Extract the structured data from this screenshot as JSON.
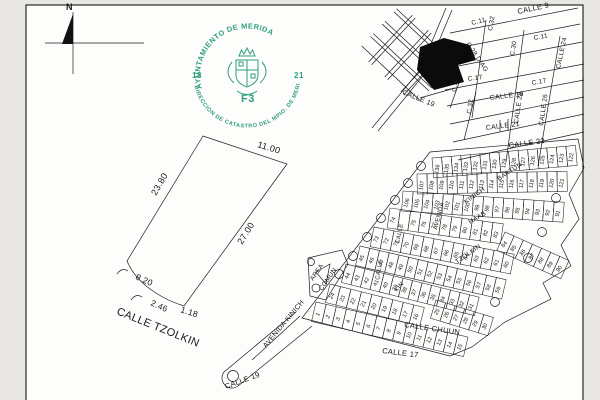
{
  "compass": {
    "label": "N"
  },
  "seal": {
    "top_text": "AYUNTAMIENTO DE MERIDA",
    "bottom_text": "DIRECCION DE CATASTRO DEL MPIO. DE MERIDA",
    "left_number": "18",
    "right_number": "21",
    "code": "F3",
    "color": "#2f9f7c"
  },
  "parcel": {
    "street_label": {
      "t": "CALLE TZOLKIN",
      "x": 116,
      "y": 314,
      "r": 22,
      "s": 11
    },
    "dimensions": [
      {
        "t": "11.00",
        "x": 257,
        "y": 147,
        "r": 17,
        "s": 9
      },
      {
        "t": "23.80",
        "x": 156,
        "y": 196,
        "r": -60,
        "s": 9
      },
      {
        "t": "27.00",
        "x": 242,
        "y": 245,
        "r": -58,
        "s": 9
      },
      {
        "t": "8.20",
        "x": 135,
        "y": 279,
        "r": 24,
        "s": 8.5
      },
      {
        "t": "2.46",
        "x": 150,
        "y": 305,
        "r": 24,
        "s": 8.5
      },
      {
        "t": "1.18",
        "x": 180,
        "y": 312,
        "r": 18,
        "s": 8.5
      }
    ]
  },
  "city_map": {
    "labels": [
      {
        "t": "CALLE 9",
        "x": 518,
        "y": 14,
        "r": -12,
        "s": 7.5
      },
      {
        "t": "C.11",
        "x": 472,
        "y": 25,
        "r": -14,
        "s": 6.5
      },
      {
        "t": "C.32",
        "x": 492,
        "y": 31,
        "r": -80,
        "s": 6.5
      },
      {
        "t": "C.28 DIAG",
        "x": 466,
        "y": 44,
        "r": 56,
        "s": 6.5
      },
      {
        "t": "C.11",
        "x": 534,
        "y": 40,
        "r": -10,
        "s": 6.5
      },
      {
        "t": "C.30",
        "x": 514,
        "y": 56,
        "r": -80,
        "s": 6.5
      },
      {
        "t": "CALLE 24",
        "x": 560,
        "y": 69,
        "r": -78,
        "s": 6.5
      },
      {
        "t": "C.17",
        "x": 468,
        "y": 81,
        "r": -8,
        "s": 6.5
      },
      {
        "t": "C.17",
        "x": 532,
        "y": 85,
        "r": -10,
        "s": 6.5
      },
      {
        "t": "127.00",
        "x": 437,
        "y": 88,
        "r": -15,
        "s": 6.5
      },
      {
        "t": "C.34",
        "x": 456,
        "y": 92,
        "r": -82,
        "s": 6
      },
      {
        "t": "CALLE 19",
        "x": 402,
        "y": 94,
        "r": 22,
        "s": 7
      },
      {
        "t": "CALLE 19",
        "x": 490,
        "y": 100,
        "r": -7,
        "s": 7
      },
      {
        "t": "C.32",
        "x": 471,
        "y": 114,
        "r": -82,
        "s": 6.5
      },
      {
        "t": "CALLE 28",
        "x": 518,
        "y": 124,
        "r": -82,
        "s": 6.5
      },
      {
        "t": "CALLE 26",
        "x": 543,
        "y": 126,
        "r": -82,
        "s": 6.5
      },
      {
        "t": "CALLE 21",
        "x": 486,
        "y": 130,
        "r": -7,
        "s": 7
      },
      {
        "t": "CALLE 23",
        "x": 509,
        "y": 148,
        "r": -8,
        "s": 7.5
      }
    ]
  },
  "subdivision": {
    "streets": [
      {
        "t": "AVENIDA KINICH",
        "x": 266,
        "y": 348,
        "r": -50,
        "s": 7
      },
      {
        "t": "AREA",
        "x": 313,
        "y": 281,
        "r": -55,
        "s": 6.5
      },
      {
        "t": "COMUN",
        "x": 322,
        "y": 291,
        "r": -55,
        "s": 6.5
      },
      {
        "t": "CALLE CHUUN",
        "x": 404,
        "y": 327,
        "r": 8,
        "s": 7.5
      },
      {
        "t": "CALLE 17",
        "x": 382,
        "y": 353,
        "r": 7,
        "s": 7.5
      },
      {
        "t": "CALLE 19",
        "x": 226,
        "y": 389,
        "r": -20,
        "s": 7.5
      },
      {
        "t": "KINICH",
        "x": 466,
        "y": 204,
        "r": -36,
        "s": 6.5
      },
      {
        "t": "BAKTUN",
        "x": 499,
        "y": 181,
        "r": -34,
        "s": 6.5
      },
      {
        "t": "HAAB",
        "x": 470,
        "y": 224,
        "r": -30,
        "s": 6.5
      },
      {
        "t": "TZOLKIN",
        "x": 457,
        "y": 264,
        "r": -35,
        "s": 6.5
      },
      {
        "t": "KIN",
        "x": 397,
        "y": 292,
        "r": -50,
        "s": 6
      },
      {
        "t": "AVENIDA",
        "x": 437,
        "y": 230,
        "r": -76,
        "s": 6
      },
      {
        "t": "CALLE",
        "x": 379,
        "y": 280,
        "r": -80,
        "s": 6
      },
      {
        "t": "CALLE",
        "x": 399,
        "y": 244,
        "r": -78,
        "s": 6
      }
    ],
    "bands": [
      {
        "x": 432,
        "y": 158,
        "a": -5,
        "s": 9.6,
        "h": 20,
        "nums": [
          "136",
          "135",
          "134",
          "133",
          "132",
          "131",
          "130",
          "129",
          "128",
          "127",
          "126",
          "125",
          "124",
          "123",
          "122"
        ]
      },
      {
        "x": 417,
        "y": 174,
        "a": -1,
        "s": 10,
        "h": 20,
        "nums": [
          "107",
          "108",
          "109",
          "110",
          "111",
          "112",
          "113",
          "114",
          "115",
          "116",
          "117",
          "118",
          "119",
          "120",
          "121"
        ]
      },
      {
        "x": 403,
        "y": 191,
        "a": 4,
        "s": 10.1,
        "h": 20,
        "nums": [
          "106",
          "105",
          "104",
          "103",
          "102",
          "101",
          "100",
          "99",
          "98",
          "97",
          "96",
          "95",
          "94",
          "93",
          "92",
          "91"
        ]
      },
      {
        "x": 390,
        "y": 208,
        "a": 8,
        "s": 10.4,
        "h": 20,
        "nums": [
          "74",
          "",
          "75",
          "76",
          "77",
          "78",
          "79",
          "80",
          "81",
          "82",
          "83"
        ]
      },
      {
        "x": 505,
        "y": 232,
        "a": 24,
        "s": 10,
        "h": 20,
        "nums": [
          "84",
          "85",
          "86",
          "87",
          "88",
          "89",
          "90"
        ]
      },
      {
        "x": 374,
        "y": 227,
        "a": 11,
        "s": 10.2,
        "h": 20,
        "nums": [
          "73",
          "72",
          "71",
          "70",
          "69",
          "68",
          "67",
          "66",
          "65",
          "64",
          "63",
          "62",
          "61",
          "60"
        ]
      },
      {
        "x": 360,
        "y": 246,
        "a": 13,
        "s": 10,
        "h": 20,
        "nums": [
          "45",
          "46",
          "47",
          "48",
          "49",
          "50",
          "51",
          "52",
          "53",
          "54",
          "55",
          "56",
          "57",
          "58",
          "59"
        ]
      },
      {
        "x": 346,
        "y": 264,
        "a": 14,
        "s": 9.8,
        "h": 19,
        "nums": [
          "44",
          "43",
          "42",
          "41",
          "40",
          "39",
          "38",
          "37",
          "36",
          "35",
          "34",
          "33",
          "32",
          "31"
        ]
      },
      {
        "x": 330,
        "y": 284,
        "a": 14,
        "s": 10.8,
        "h": 19,
        "nums": [
          "24",
          "23",
          "22",
          "21",
          "20",
          "19",
          "18",
          "17",
          "16"
        ]
      },
      {
        "x": 436,
        "y": 300,
        "a": 17,
        "s": 10,
        "h": 19,
        "nums": [
          "25",
          "26",
          "27",
          "28",
          "29",
          "30"
        ]
      },
      {
        "x": 316,
        "y": 302,
        "a": 13,
        "s": 10.4,
        "h": 20,
        "nums": [
          "1",
          "2",
          "3",
          "4",
          "5",
          "6",
          "7",
          "8",
          "9",
          "10",
          "11",
          "12",
          "13",
          "14",
          "15"
        ]
      }
    ]
  }
}
